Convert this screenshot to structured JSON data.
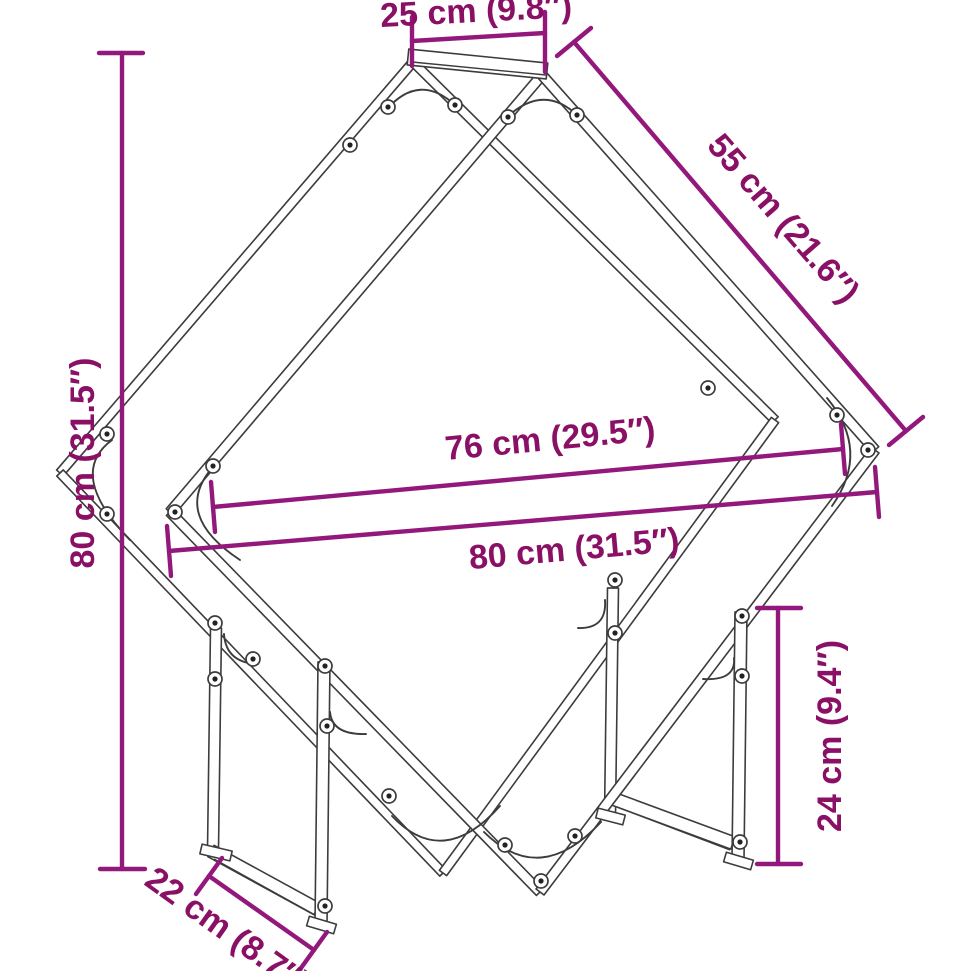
{
  "figure": {
    "title": "Firewood rack dimensional line drawing",
    "unit_system": "cm with inch equivalents"
  },
  "colors": {
    "dimension_line": "#93187B",
    "dimension_text": "#8A1066",
    "artwork_line": "#3C3C3C",
    "background": "#FFFFFF"
  },
  "label_font_size": 34,
  "dimensions": [
    {
      "id": "top-depth",
      "label": "25 cm (9.8″)",
      "line": [
        412,
        41,
        545,
        33
      ],
      "ticks": [
        [
          412,
          17,
          412,
          66
        ],
        [
          545,
          12,
          545,
          72
        ]
      ],
      "text": {
        "x": 476,
        "y": 10,
        "rot": -3
      }
    },
    {
      "id": "side-length",
      "label": "55 cm (21.6″)",
      "line": [
        574,
        42,
        906,
        431
      ],
      "ticks": [
        [
          557,
          56,
          591,
          28
        ],
        [
          889,
          445,
          923,
          417
        ]
      ],
      "text": {
        "x": 784,
        "y": 218,
        "rot": 49
      }
    },
    {
      "id": "height",
      "label": "80 cm (31.5″)",
      "line": [
        122,
        53,
        122,
        869
      ],
      "ticks": [
        [
          99,
          53,
          143,
          53
        ],
        [
          100,
          869,
          145,
          869
        ]
      ],
      "text": {
        "x": 82,
        "y": 463,
        "rot": -90
      }
    },
    {
      "id": "inner-width",
      "label": "76 cm (29.5″)",
      "line": [
        213,
        507,
        843,
        449
      ],
      "ticks": [
        [
          211,
          482,
          215,
          532
        ],
        [
          841,
          424,
          845,
          474
        ]
      ],
      "text": {
        "x": 550,
        "y": 438,
        "rot": -5.5
      }
    },
    {
      "id": "overall-width",
      "label": "80 cm (31.5″)",
      "line": [
        169,
        551,
        877,
        492
      ],
      "ticks": [
        [
          167,
          526,
          171,
          576
        ],
        [
          875,
          467,
          879,
          517
        ]
      ],
      "text": {
        "x": 574,
        "y": 548,
        "rot": -5
      }
    },
    {
      "id": "leg-height",
      "label": "24 cm (9.4″)",
      "line": [
        778,
        608,
        778,
        864
      ],
      "ticks": [
        [
          757,
          608,
          801,
          608
        ],
        [
          757,
          864,
          801,
          864
        ]
      ],
      "text": {
        "x": 829,
        "y": 736,
        "rot": -90
      }
    },
    {
      "id": "base-depth",
      "label": "22 cm (8.7″)",
      "line": [
        209,
        876,
        314,
        950
      ],
      "ticks": [
        [
          196,
          894,
          222,
          858
        ],
        [
          301,
          968,
          327,
          932
        ]
      ],
      "text": {
        "x": 228,
        "y": 930,
        "rot": 35.5
      }
    }
  ],
  "structure": {
    "tubes": [
      {
        "name": "back-upper-left",
        "x1": 413,
        "y1": 62,
        "x2": 60,
        "y2": 473,
        "w": 9
      },
      {
        "name": "back-upper-right",
        "x1": 413,
        "y1": 62,
        "x2": 775,
        "y2": 420,
        "w": 9
      },
      {
        "name": "back-lower-left",
        "x1": 60,
        "y1": 473,
        "x2": 443,
        "y2": 873,
        "w": 9
      },
      {
        "name": "back-lower-right",
        "x1": 775,
        "y1": 420,
        "x2": 443,
        "y2": 873,
        "w": 9
      },
      {
        "name": "back-left-leg",
        "x1": 216,
        "y1": 628,
        "x2": 213,
        "y2": 850,
        "w": 11
      },
      {
        "name": "back-right-leg",
        "x1": 613,
        "y1": 588,
        "x2": 610,
        "y2": 816,
        "w": 11
      },
      {
        "name": "left-base-rail",
        "x1": 211,
        "y1": 851,
        "x2": 317,
        "y2": 909,
        "w": 13
      },
      {
        "name": "right-base-rail",
        "x1": 614,
        "y1": 799,
        "x2": 733,
        "y2": 843,
        "w": 13
      },
      {
        "name": "front-upper-left",
        "x1": 542,
        "y1": 75,
        "x2": 170,
        "y2": 512,
        "w": 10
      },
      {
        "name": "front-upper-right",
        "x1": 542,
        "y1": 75,
        "x2": 875,
        "y2": 450,
        "w": 10
      },
      {
        "name": "front-lower-left",
        "x1": 170,
        "y1": 512,
        "x2": 540,
        "y2": 892,
        "w": 10
      },
      {
        "name": "front-lower-right",
        "x1": 875,
        "y1": 450,
        "x2": 540,
        "y2": 892,
        "w": 10
      },
      {
        "name": "front-left-leg",
        "x1": 324,
        "y1": 662,
        "x2": 321,
        "y2": 924,
        "w": 12
      },
      {
        "name": "front-right-leg",
        "x1": 741,
        "y1": 612,
        "x2": 738,
        "y2": 860,
        "w": 12
      },
      {
        "name": "top-bar",
        "x1": 408,
        "y1": 57,
        "x2": 547,
        "y2": 71,
        "w": 16
      },
      {
        "name": "back-left-foot",
        "x1": 201,
        "y1": 849,
        "x2": 231,
        "y2": 856,
        "w": 10
      },
      {
        "name": "front-left-foot",
        "x1": 308,
        "y1": 921,
        "x2": 335,
        "y2": 929,
        "w": 10
      },
      {
        "name": "back-right-foot",
        "x1": 597,
        "y1": 813,
        "x2": 624,
        "y2": 820,
        "w": 10
      },
      {
        "name": "front-right-foot",
        "x1": 725,
        "y1": 857,
        "x2": 752,
        "y2": 865,
        "w": 10
      }
    ],
    "detail_lines": [
      [
        412,
        62,
        546,
        75
      ],
      [
        214,
        859,
        315,
        915
      ],
      [
        617,
        807,
        730,
        850
      ]
    ],
    "gussets": [
      {
        "name": "gusset-back-top",
        "d": "M387,109 Q420,72 456,106"
      },
      {
        "name": "gusset-front-top",
        "d": "M505,119 Q543,82 578,116"
      },
      {
        "name": "gusset-back-left",
        "d": "M112,440 Q66,474 130,540"
      },
      {
        "name": "gusset-front-left",
        "d": "M212,468 Q172,515 240,560"
      },
      {
        "name": "gusset-front-right",
        "d": "M827,398 Q871,451 832,506"
      },
      {
        "name": "gusset-front-bottom",
        "d": "M484,832 Q540,888 601,822"
      },
      {
        "name": "gusset-back-bottom",
        "d": "M392,816 Q443,870 500,806"
      },
      {
        "name": "bracket-back-left-leg",
        "d": "M224,634 Q226,663 258,664"
      },
      {
        "name": "bracket-front-left-leg",
        "d": "M330,712 Q332,735 366,734"
      },
      {
        "name": "bracket-back-right-leg",
        "d": "M605,600 Q607,629 578,628"
      },
      {
        "name": "bracket-front-right-leg",
        "d": "M734,658 Q736,681 703,679"
      }
    ],
    "screws": [
      [
        388,
        107
      ],
      [
        455,
        105
      ],
      [
        508,
        117
      ],
      [
        577,
        115
      ],
      [
        350,
        145
      ],
      [
        708,
        388
      ],
      [
        837,
        415
      ],
      [
        868,
        450
      ],
      [
        107,
        434
      ],
      [
        107,
        514
      ],
      [
        175,
        512
      ],
      [
        213,
        466
      ],
      [
        215,
        623
      ],
      [
        215,
        679
      ],
      [
        253,
        659
      ],
      [
        325,
        666
      ],
      [
        327,
        726
      ],
      [
        325,
        906
      ],
      [
        615,
        580
      ],
      [
        615,
        633
      ],
      [
        742,
        616
      ],
      [
        742,
        676
      ],
      [
        740,
        842
      ],
      [
        389,
        796
      ],
      [
        505,
        845
      ],
      [
        541,
        881
      ],
      [
        575,
        836
      ]
    ]
  }
}
